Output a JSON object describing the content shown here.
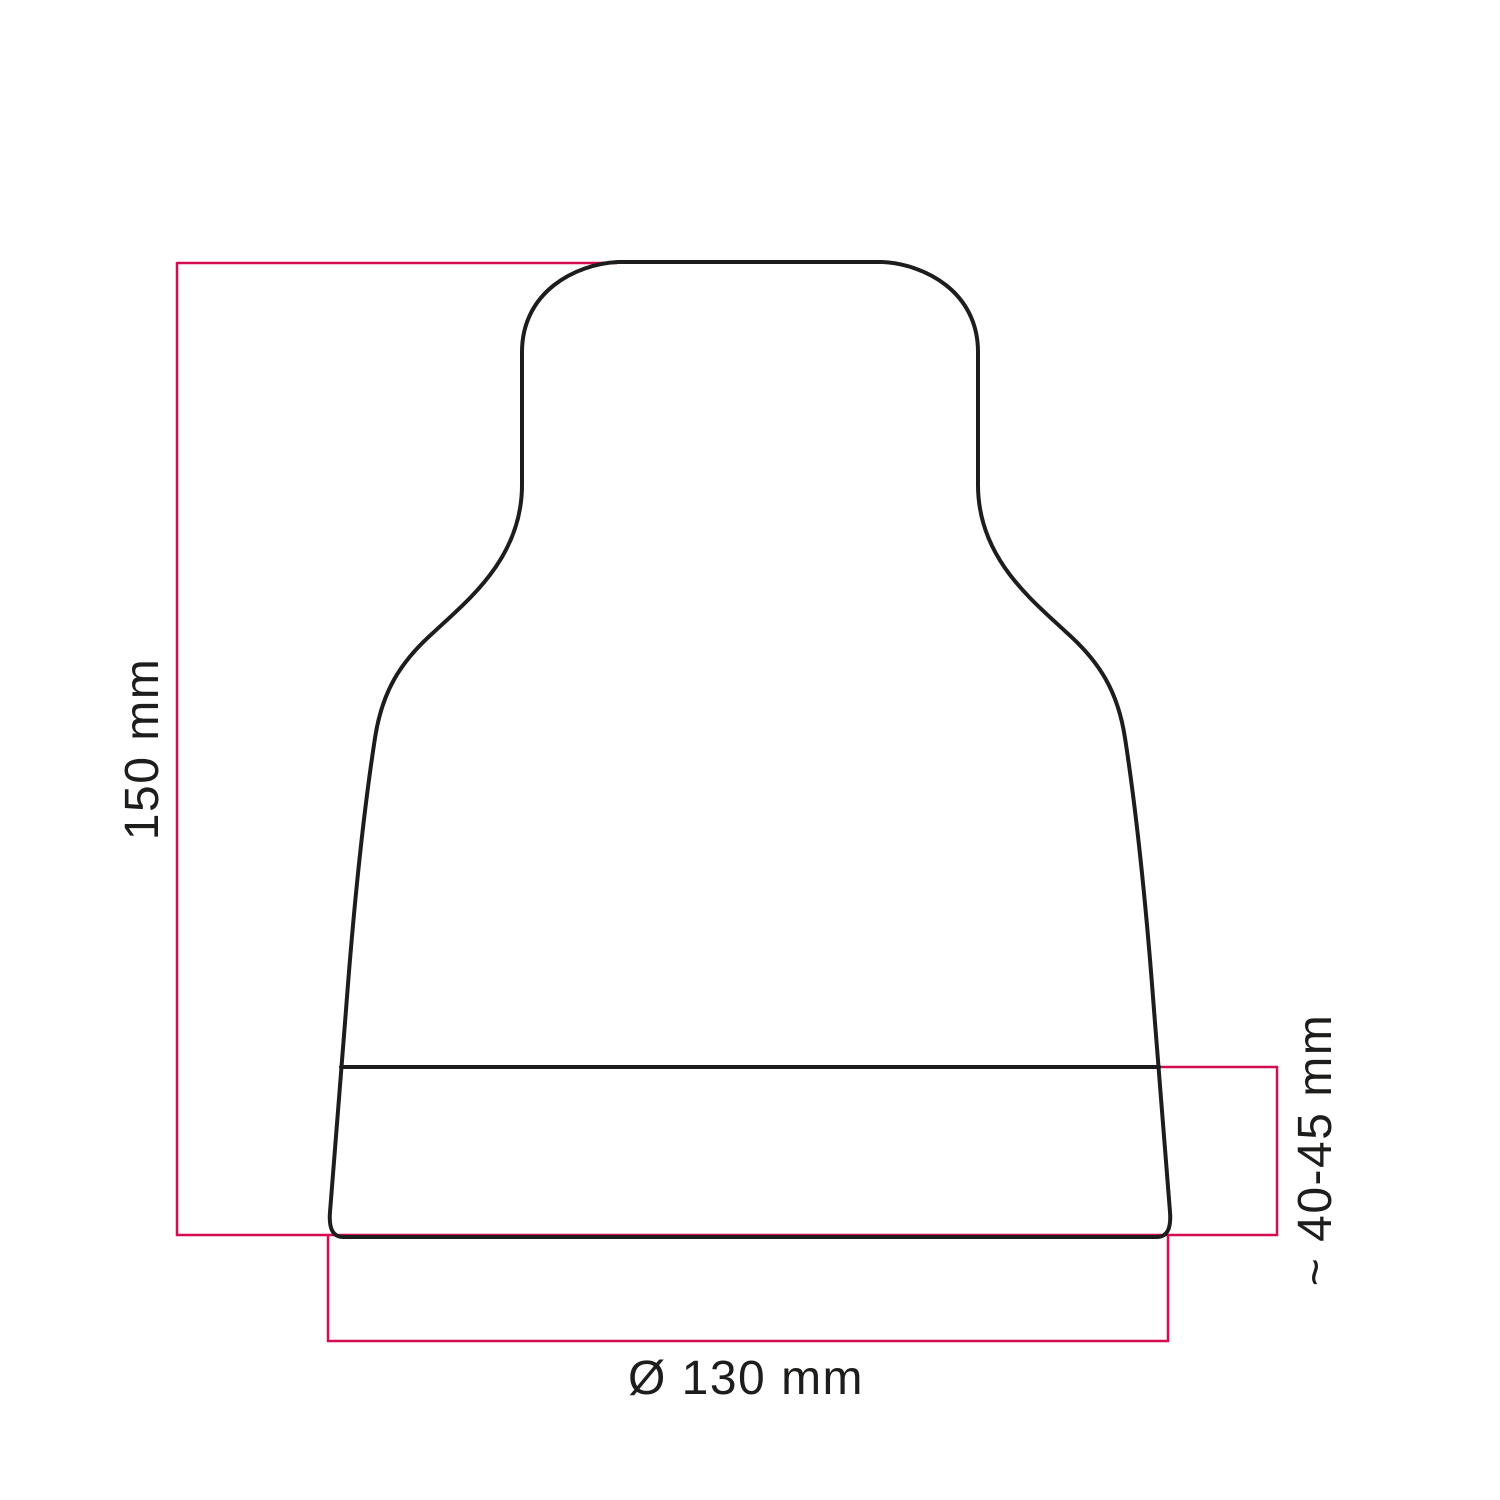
{
  "diagram": {
    "labels": {
      "height": "150 mm",
      "collar_height": "~ 40-45 mm",
      "diameter": "Ø 130 mm"
    }
  },
  "colors": {
    "outline": "#1d1d1b",
    "dimension": "#d60b52",
    "background": "#ffffff"
  }
}
